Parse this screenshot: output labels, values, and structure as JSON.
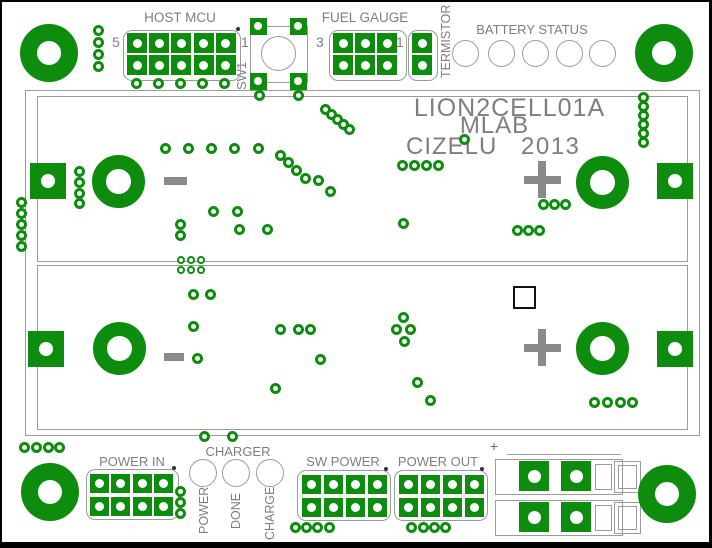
{
  "colors": {
    "green": "#0e8c0e",
    "outline_gray": "#9b9b9b",
    "text_gray": "#7e7e7e",
    "symbol_gray": "#8a8a8a",
    "dark": "#333333"
  },
  "labels": {
    "host_mcu": "HOST MCU",
    "host_mcu_pin_left": "5",
    "host_mcu_pin_right": "1",
    "sw1": "SW1",
    "fuel_gauge": "FUEL GAUGE",
    "fuel_gauge_pin_left": "3",
    "fuel_gauge_pin_right": "1",
    "termistor": "TERMISTOR",
    "battery_status": "BATTERY STATUS",
    "board_name": "LION2CELL01A",
    "org": "MLAB",
    "author": "CIZELU",
    "year": "2013",
    "cell_minus": "-",
    "cell_plus": "+",
    "power_in": "POWER IN",
    "charger": "CHARGER",
    "charger_led_1": "POWER",
    "charger_led_2": "DONE",
    "charger_led_3": "CHARGE",
    "sw_power": "SW POWER",
    "power_out": "POWER OUT",
    "terminal_plus": "+"
  },
  "pcb": {
    "board_outline": [
      23,
      88,
      673,
      344
    ],
    "cell_outlines": [
      [
        35,
        94,
        649,
        164
      ],
      [
        35,
        263,
        649,
        163
      ]
    ],
    "mount_holes": [
      [
        47,
        51
      ],
      [
        662,
        51
      ],
      [
        48,
        490
      ],
      [
        665,
        492
      ]
    ],
    "cell_terminals": [
      [
        117,
        180
      ],
      [
        601,
        181
      ],
      [
        118,
        347
      ],
      [
        601,
        347
      ]
    ],
    "edge_pads": [
      [
        46,
        179
      ],
      [
        673,
        179
      ],
      [
        44,
        347
      ],
      [
        673,
        347
      ]
    ],
    "headers": [
      {
        "id": "host-mcu-header",
        "x": 135,
        "y": 41,
        "cols": 5,
        "rows": 2,
        "px": 22.2,
        "py": 22,
        "pad": 20,
        "outline": [
          121,
          28,
          116,
          49
        ],
        "dot": [
          236,
          27
        ]
      },
      {
        "id": "fuel-gauge-header",
        "x": 341,
        "y": 41,
        "cols": 3,
        "rows": 2,
        "px": 22,
        "py": 22,
        "pad": 20,
        "outline": [
          327,
          28,
          76,
          49
        ]
      },
      {
        "id": "termistor-header",
        "x": 420,
        "y": 41,
        "cols": 1,
        "rows": 2,
        "px": 22,
        "py": 22,
        "pad": 20,
        "outline": [
          406,
          28,
          28,
          49
        ]
      },
      {
        "id": "power-in-header",
        "x": 97,
        "y": 481,
        "cols": 4,
        "rows": 2,
        "px": 21.5,
        "py": 23,
        "pad": 19,
        "outline": [
          84,
          467,
          91,
          49
        ],
        "dot": [
          172,
          466
        ]
      },
      {
        "id": "sw-power-header",
        "x": 309,
        "y": 482,
        "cols": 4,
        "rows": 2,
        "px": 22.3,
        "py": 23,
        "pad": 19,
        "outline": [
          295,
          468,
          92,
          49
        ],
        "dot": [
          384,
          467
        ]
      },
      {
        "id": "power-out-header",
        "x": 406,
        "y": 482,
        "cols": 4,
        "rows": 2,
        "px": 22,
        "py": 23,
        "pad": 19,
        "outline": [
          392,
          468,
          92,
          49
        ],
        "dot": [
          480,
          467
        ]
      }
    ],
    "sw1": {
      "pads": [
        [
          256,
          24
        ],
        [
          296,
          24
        ],
        [
          256,
          79
        ],
        [
          296,
          79
        ]
      ],
      "circle": [
        276,
        51
      ],
      "body": [
        248,
        24,
        304,
        79
      ]
    },
    "status_leds": [
      [
        463,
        51
      ],
      [
        499,
        51
      ],
      [
        533,
        51
      ],
      [
        567,
        51
      ],
      [
        600,
        51
      ]
    ],
    "charger_leds": [
      [
        201,
        471
      ],
      [
        234,
        471
      ],
      [
        268,
        471
      ]
    ],
    "terminal_blocks": [
      {
        "y": 457
      },
      {
        "y": 498
      }
    ],
    "smd_square": [
      511,
      284,
      23
    ],
    "vias": [
      [
        96,
        28
      ],
      [
        96,
        40
      ],
      [
        96,
        52
      ],
      [
        96,
        64
      ],
      [
        134,
        81
      ],
      [
        156,
        81
      ],
      [
        178,
        81
      ],
      [
        200,
        81
      ],
      [
        222,
        81
      ],
      [
        257,
        93
      ],
      [
        296,
        93
      ],
      [
        323,
        107
      ],
      [
        329,
        112
      ],
      [
        335,
        117
      ],
      [
        341,
        122
      ],
      [
        347,
        127
      ],
      [
        163,
        146
      ],
      [
        186,
        146
      ],
      [
        209,
        146
      ],
      [
        232,
        146
      ],
      [
        256,
        146
      ],
      [
        278,
        153
      ],
      [
        286,
        160
      ],
      [
        294,
        168
      ],
      [
        303,
        176
      ],
      [
        316,
        178
      ],
      [
        328,
        189
      ],
      [
        77,
        169
      ],
      [
        77,
        180
      ],
      [
        77,
        191
      ],
      [
        77,
        201
      ],
      [
        211,
        209
      ],
      [
        235,
        209
      ],
      [
        178,
        222
      ],
      [
        178,
        233
      ],
      [
        237,
        227
      ],
      [
        265,
        227
      ],
      [
        400,
        163
      ],
      [
        412,
        163
      ],
      [
        424,
        163
      ],
      [
        436,
        163
      ],
      [
        462,
        137
      ],
      [
        641,
        95
      ],
      [
        641,
        104
      ],
      [
        641,
        113
      ],
      [
        641,
        122
      ],
      [
        641,
        131
      ],
      [
        641,
        140
      ],
      [
        541,
        202
      ],
      [
        552,
        202
      ],
      [
        563,
        202
      ],
      [
        401,
        221
      ],
      [
        515,
        228
      ],
      [
        526,
        228
      ],
      [
        537,
        228
      ],
      [
        19,
        200
      ],
      [
        19,
        211
      ],
      [
        19,
        222
      ],
      [
        19,
        233
      ],
      [
        19,
        244
      ],
      [
        191,
        292
      ],
      [
        208,
        292
      ],
      [
        191,
        324
      ],
      [
        195,
        356
      ],
      [
        278,
        327
      ],
      [
        296,
        327
      ],
      [
        308,
        327
      ],
      [
        318,
        357
      ],
      [
        273,
        386
      ],
      [
        401,
        315
      ],
      [
        394,
        327
      ],
      [
        408,
        327
      ],
      [
        402,
        339
      ],
      [
        415,
        380
      ],
      [
        428,
        398
      ],
      [
        592,
        400
      ],
      [
        605,
        400
      ],
      [
        618,
        400
      ],
      [
        630,
        400
      ],
      [
        202,
        434
      ],
      [
        230,
        434
      ],
      [
        22,
        445
      ],
      [
        34,
        445
      ],
      [
        46,
        445
      ],
      [
        57,
        445
      ],
      [
        178,
        489
      ],
      [
        178,
        500
      ],
      [
        178,
        511
      ],
      [
        293,
        525
      ],
      [
        304,
        525
      ],
      [
        315,
        525
      ],
      [
        327,
        525
      ],
      [
        409,
        525
      ],
      [
        421,
        525
      ],
      [
        432,
        525
      ],
      [
        443,
        525
      ]
    ],
    "vias_small": [
      [
        179,
        258
      ],
      [
        189,
        258
      ],
      [
        199,
        258
      ],
      [
        179,
        268
      ],
      [
        189,
        268
      ],
      [
        199,
        268
      ]
    ]
  }
}
